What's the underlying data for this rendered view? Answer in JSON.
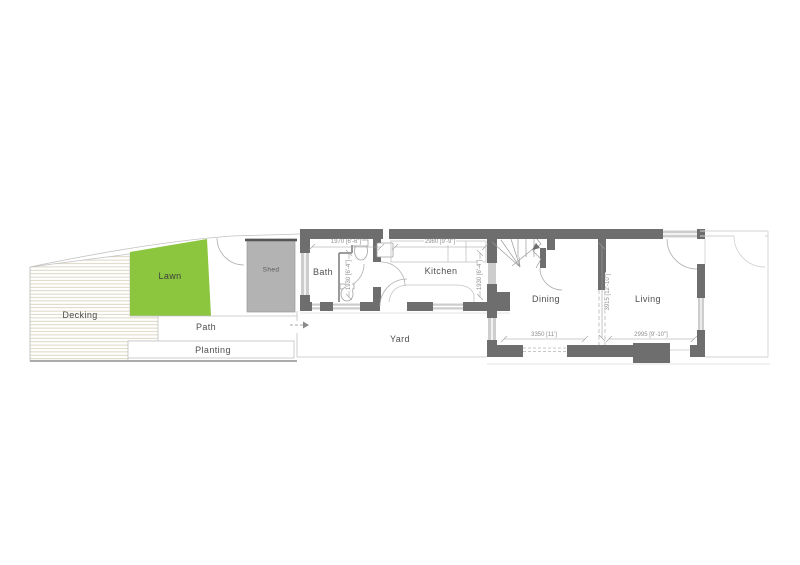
{
  "plan": {
    "type": "ground-floor-plan",
    "areas": {
      "decking": "Decking",
      "lawn": "Lawn",
      "shed": "Shed",
      "path": "Path",
      "planting": "Planting"
    },
    "rooms": {
      "bath": "Bath",
      "kitchen": "Kitchen",
      "yard": "Yard",
      "dining": "Dining",
      "living": "Living"
    },
    "dimensions": {
      "bath_width": "1970 [6'-6\"]",
      "bath_depth": "1930 [6'-4\"]",
      "kitchen_width": "2980 [9'-9\"]",
      "kitchen_depth": "1930 [6'-4\"]",
      "dining_width": "3350 [11']",
      "dining_depth": "3915 [12'-10\"]",
      "living_width": "2995 [9'-10\"]"
    },
    "colors": {
      "wall": "#6e6e6e",
      "lawn": "#8cc63f",
      "shed": "#b3b3b3",
      "glazing": "#cdcdcd",
      "boundary_line": "#c2c2c2",
      "label_text": "#4f4f4f",
      "dimension_text": "#8f8f8f"
    }
  }
}
